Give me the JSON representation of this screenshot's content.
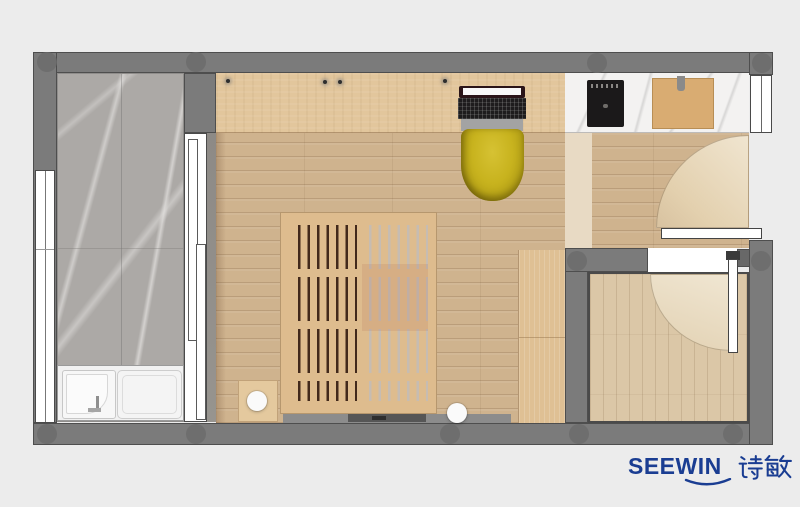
{
  "figure": {
    "type": "floor-plan",
    "description_source": "rendered pixels only"
  },
  "branding": {
    "name": "SEEWIN",
    "cjk": "诗敏"
  },
  "palette": {
    "bg": "#ECECEC",
    "wall": "#7B7B7B",
    "wall_outline": "#4E4E4E",
    "wall_dot": "#6C6C6C",
    "balcony_marble": "#ACA9A6",
    "floor_wood": "#CFB38E",
    "desk_wood": "#E2C69C",
    "bed_wood": "#DEBC8E",
    "bed_gap_dark": "#42291B",
    "bed_gap_light": "#C6BCB2",
    "chair_yellow": "#C8B31E",
    "counter_marble": "#F3F2F1",
    "cooktop_black": "#1B191A",
    "cutting_board": "#D9AC72",
    "wardrobe_wood": "#DFC094",
    "hallway_light": "#E8DAC4",
    "bathroom_floor": "#DBC7A7",
    "fixture_white": "#F1F1F1",
    "logo_blue": "#1A3D92"
  }
}
